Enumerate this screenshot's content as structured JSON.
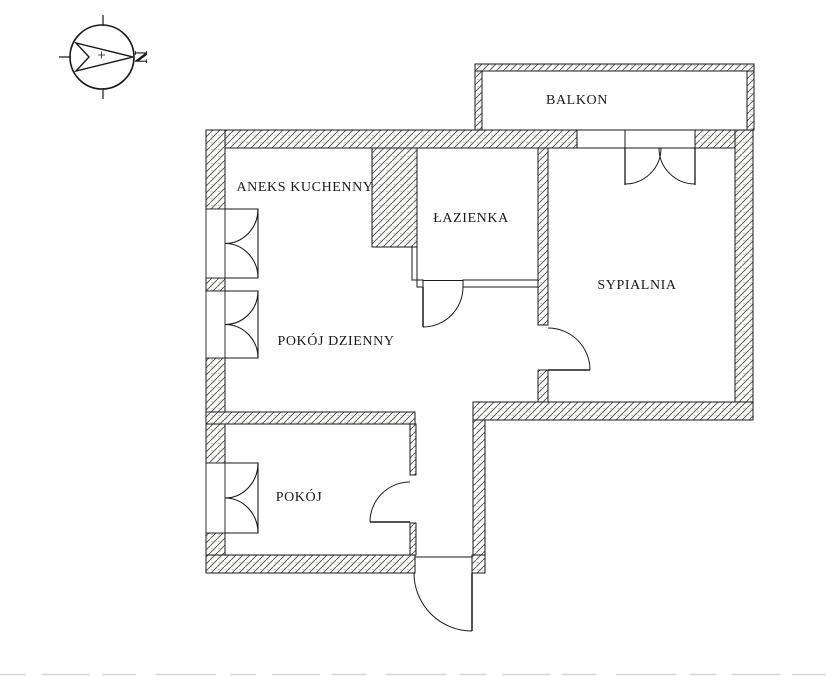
{
  "diagram_type": "apartment-floor-plan",
  "compass": {
    "north_label": "N"
  },
  "rooms": [
    {
      "id": "balkon",
      "label": "BALKON"
    },
    {
      "id": "aneks-kuchenny",
      "label": "ANEKS KUCHENNY"
    },
    {
      "id": "lazienka",
      "label": "ŁAZIENKA"
    },
    {
      "id": "sypialnia",
      "label": "SYPIALNIA"
    },
    {
      "id": "pokoj-dzienny",
      "label": "POKÓJ DZIENNY"
    },
    {
      "id": "pokoj",
      "label": "POKÓJ"
    }
  ],
  "colors": {
    "background": "#ffffff",
    "line": "#1a1a1a",
    "hatch_line": "#4a4a4a",
    "wall_fill": "#fbfbfa",
    "speckle": "#9a9a9a"
  }
}
